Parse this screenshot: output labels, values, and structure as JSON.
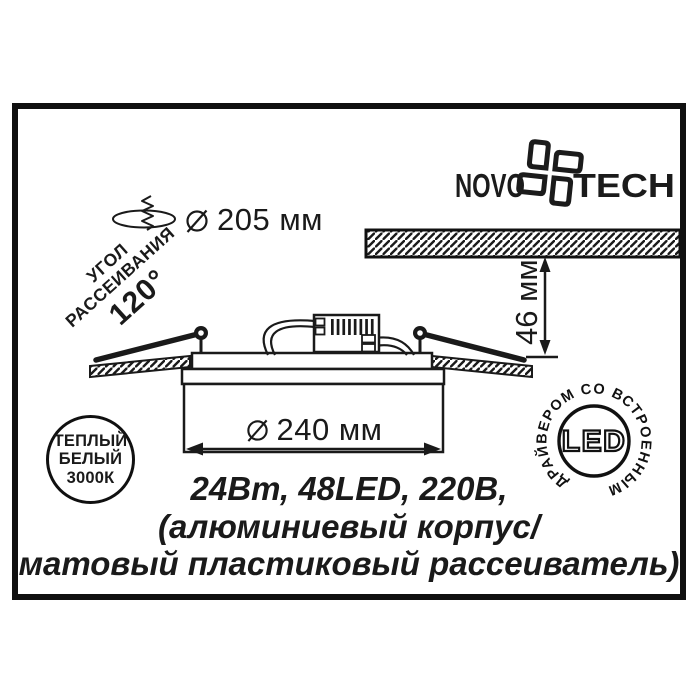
{
  "brand": {
    "left": "NOVO",
    "right": "TECH"
  },
  "dimensions": {
    "cutout_diameter": "205 мм",
    "body_diameter": "240 мм",
    "recess_height": "46 мм"
  },
  "beam_angle": {
    "line1": "УГОЛ",
    "line2": "РАССЕИВАНИЯ",
    "value": "120°"
  },
  "color_badge": {
    "line1": "ТЕПЛЫЙ",
    "line2": "БЕЛЫЙ",
    "line3": "3000К"
  },
  "led_badge": {
    "ring_text": "ДРАЙВЕРОМ СО ВСТРОЕННЫМ",
    "center": "LED"
  },
  "specs": {
    "line1": "24Вт, 48LED, 220В,",
    "line2": "(алюминиевый корпус/",
    "line3": "матовый пластиковый рассеиватель)"
  },
  "colors": {
    "ink": "#1a1a1a",
    "background": "#ffffff"
  }
}
